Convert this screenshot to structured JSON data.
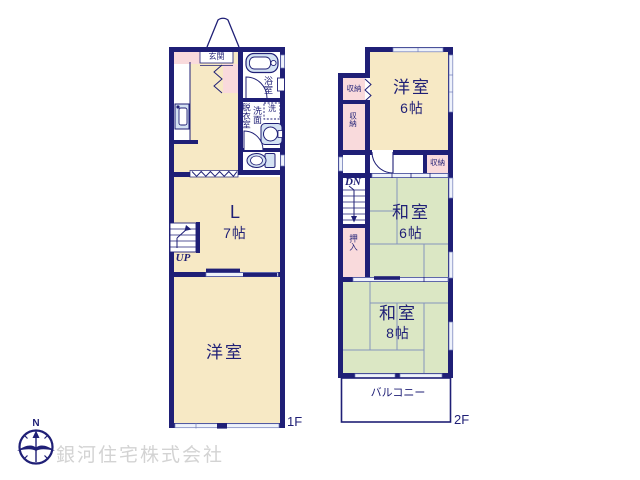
{
  "f1": {
    "floor": "1F",
    "entrance": "玄関",
    "bath": "浴室",
    "wash_machine": "洗",
    "vanity": "洗面",
    "dressing": "脱衣室",
    "living": "L",
    "living_size": "7帖",
    "up": "UP",
    "western_room": "洋室"
  },
  "f2": {
    "floor": "2F",
    "western_room": "洋室",
    "western_room_size": "6帖",
    "storage_top": "収納",
    "storage_left": "収納",
    "storage_mid": "収納",
    "dn": "DN",
    "japanese_room_6": "和室",
    "japanese_room_6_size": "6帖",
    "closet": "押入",
    "japanese_room_8": "和室",
    "japanese_room_8_size": "8帖",
    "balcony": "バルコニー"
  },
  "compass_n": "N",
  "company": "銀河住宅株式会社",
  "colors": {
    "wall": "#1f1f76",
    "room_cream": "#f7e9c5",
    "tatami_green": "#dbe7c4",
    "storage_pink": "#f9dadc",
    "fixture_blue": "#d4e2f3",
    "window_light": "#eef2fb",
    "watermark_gray": "#d3d3d3"
  }
}
